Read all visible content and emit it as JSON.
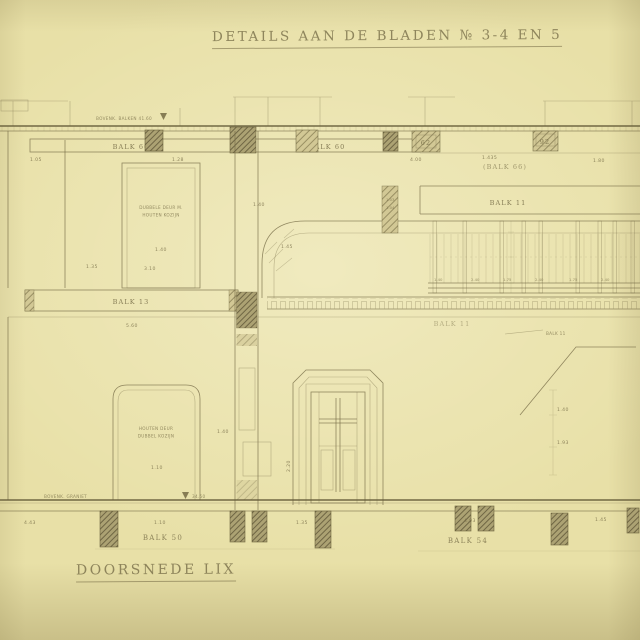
{
  "colors": {
    "paper": "#e8e0a7",
    "ink": "#766c46",
    "ink_faint": "#8a8156",
    "block_dark": "#a89d6e",
    "block_light": "#cdc394"
  },
  "title": {
    "text": "DETAILS AAN DE BLADEN № 3-4 EN 5"
  },
  "footer": {
    "section_label": "DOORSNEDE LIX"
  },
  "labels": {
    "balk60_left": "BALK 60",
    "balk60_center": "BALK 60",
    "balk66": "(BALK 66)",
    "balk11_band": "BALK 11",
    "balk11_wall": "BALK 11",
    "balk11_note": "BALK 11",
    "balk13": "BALK 13",
    "balk50": "BALK 50",
    "balk54": "BALK 54",
    "block62": "62",
    "block92": "92"
  },
  "levels": {
    "top_note": "BOVENK. BALKEN  41.60",
    "bottom_note": "BOVENK. GRANIET",
    "bottom_value": "34.50"
  },
  "notes": {
    "door_upper_1": "DUBBELE DEUR M.",
    "door_upper_2": "HOUTEN KOZIJN",
    "door_lower_1": "HOUTEN DEUR",
    "door_lower_2": "DUBBEL KOZIJN"
  },
  "dims": {
    "a105": "1.05",
    "a128": "1.28",
    "a400": "4.00",
    "a1435": "1.435",
    "a180": "1.80",
    "b135": "1.35",
    "b310": "3.10",
    "c140": "1.40",
    "c145": "1.45",
    "s103": "1.03",
    "s104": "1.04",
    "e560": "5.60",
    "r140a": "1.40",
    "r240a": "2.40",
    "r175a": "1.75",
    "r240b": "2.40",
    "r175b": "1.75",
    "r240c": "2.40",
    "u140": "1.40",
    "l110": "1.10",
    "l140": "1.40",
    "m220": "2.20",
    "p140": "1.40",
    "p193": "1.93",
    "g443": "4.43",
    "g110": "1.10",
    "g135": "1.35",
    "g493": "4.93",
    "g145": "1.45"
  }
}
